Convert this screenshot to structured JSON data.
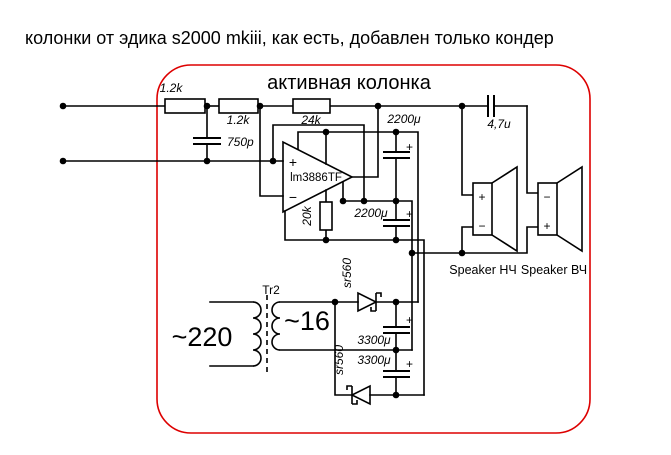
{
  "page_title": "колонки от эдика s2000 mkiii,  как есть, добавлен только кондер",
  "schematic": {
    "box_title": "активная колонка",
    "labels": {
      "r_in1": "1.2k",
      "r_in2": "1.2k",
      "c_filter": "750p",
      "r_feedback": "24k",
      "opamp": "lm3886TF",
      "r_mute": "20k",
      "c_rail_pos": "2200μ",
      "c_rail_neg": "2200μ",
      "c_out": "4,7u",
      "d_pos": "sr560",
      "d_neg": "sr560",
      "c_ps_pos": "3300μ",
      "c_ps_neg": "3300μ",
      "transformer": "Tr2",
      "primary_voltage": "~220",
      "secondary_voltage": "~16",
      "speaker_woofer": "Speaker НЧ",
      "speaker_tweeter": "Speaker ВЧ"
    },
    "polarity": {
      "plus": "+",
      "minus": "−"
    },
    "colors": {
      "border": "#dd0000",
      "wire": "#000000"
    }
  }
}
